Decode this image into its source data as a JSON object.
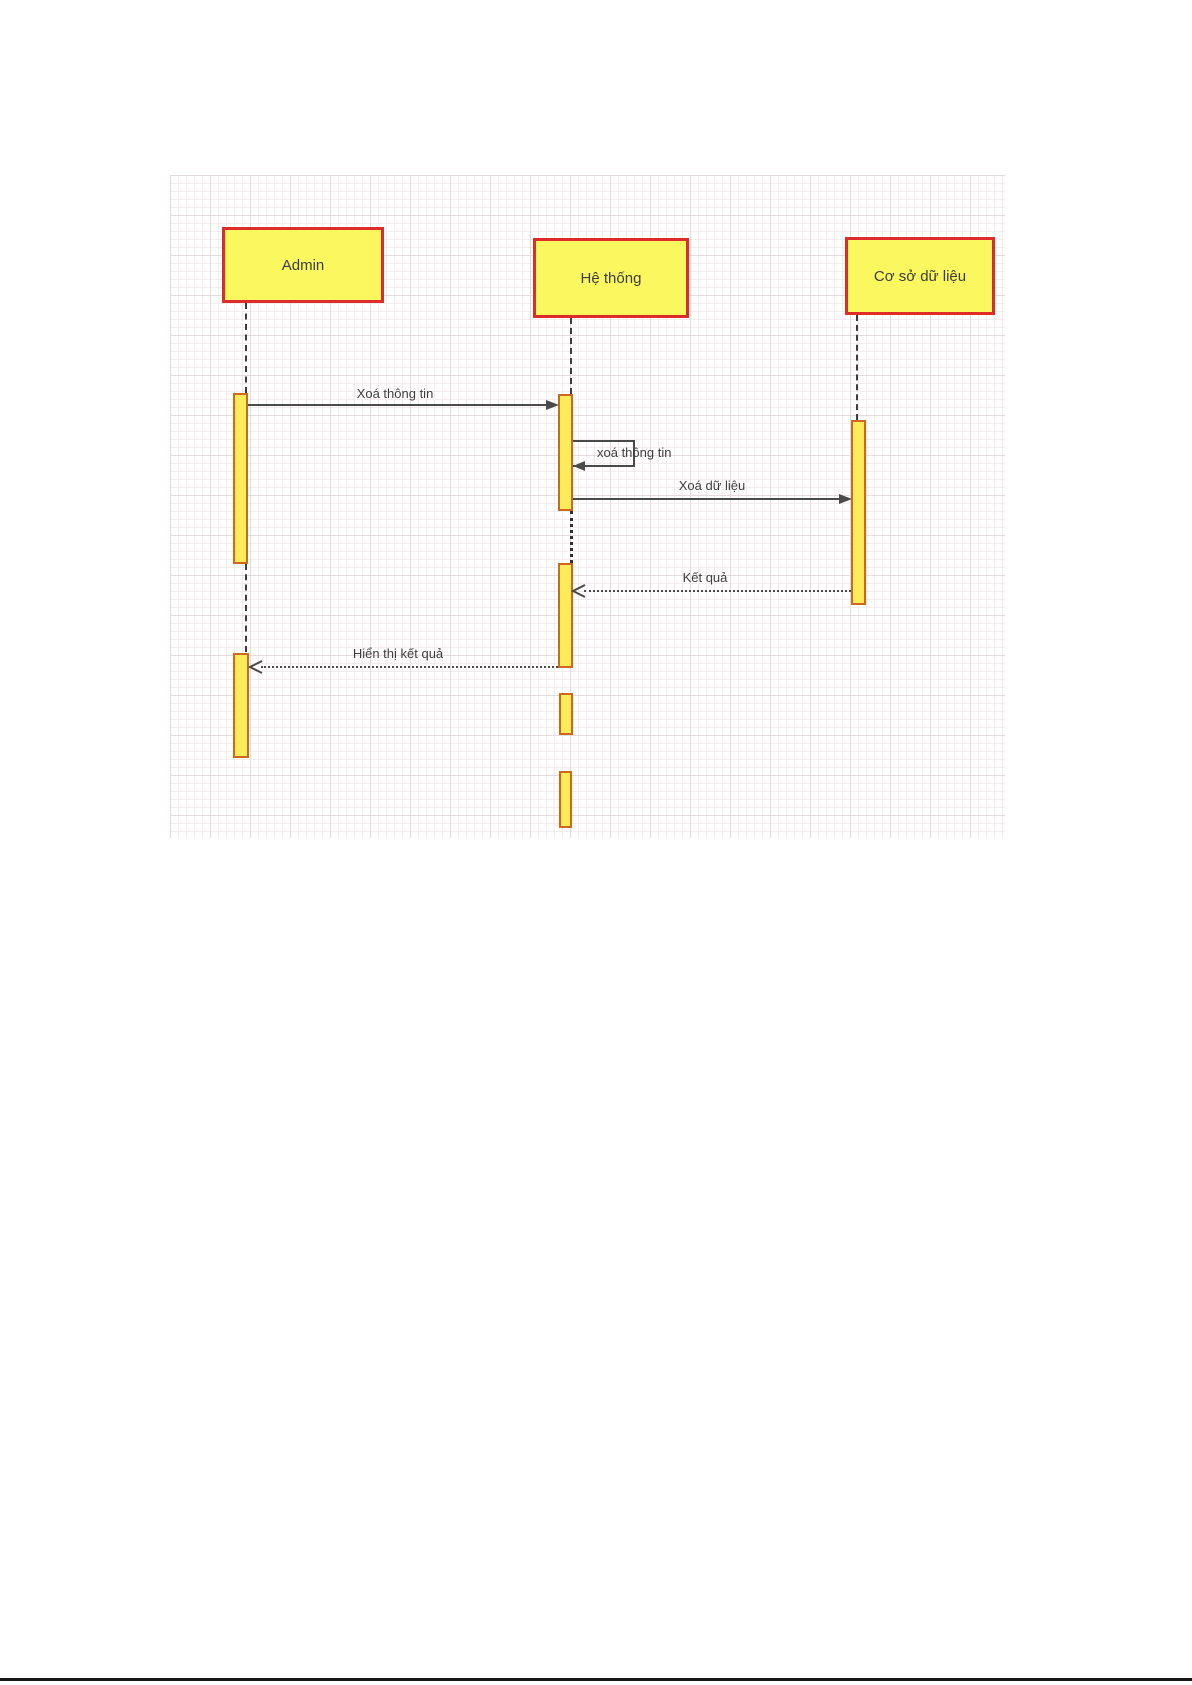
{
  "diagram": {
    "type": "uml-sequence",
    "actors": [
      {
        "label": "Admin"
      },
      {
        "label": "Hệ thống"
      },
      {
        "label": "Cơ sở dữ liệu"
      }
    ],
    "messages": [
      {
        "label": "Xoá thông tin",
        "style": "solid",
        "from": "Admin",
        "to": "Hệ thống"
      },
      {
        "label": "xoá thông tin",
        "style": "self",
        "from": "Hệ thống",
        "to": "Hệ thống"
      },
      {
        "label": "Xoá dữ liệu",
        "style": "solid",
        "from": "Hệ thống",
        "to": "Cơ sở dữ liệu"
      },
      {
        "label": "Kết quả",
        "style": "dashed",
        "from": "Cơ sở dữ liệu",
        "to": "Hệ thống"
      },
      {
        "label": "Hiển thị kết quả",
        "style": "dashed",
        "from": "Hệ thống",
        "to": "Admin"
      }
    ],
    "colors": {
      "actor_fill": "#fbf75e",
      "actor_border": "#e02b2b",
      "activation_fill": "#fdec5a",
      "activation_border": "#cf671f",
      "arrow": "#4a4a4a",
      "label_text": "#3f3f3f",
      "grid_major": "#e4dcdc",
      "grid_minor": "#f2ecec",
      "page_background": "#ffffff"
    }
  }
}
